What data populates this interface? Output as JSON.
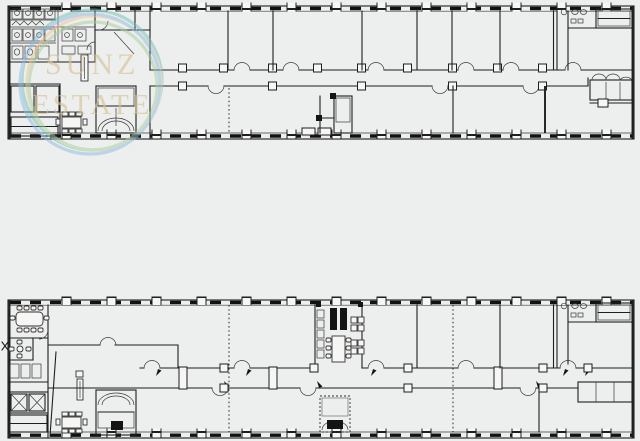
{
  "css_vars": {
    "page-bg": "#edeeee",
    "plan-fill": "#f6f6f4",
    "wall": "#1e1e1e",
    "wm-text": "#d6c093"
  },
  "watermark": {
    "line1": "SUNZ",
    "line2": "ESTATE",
    "text_color": "#d6c093",
    "ring_colors": [
      "#6fc3b4",
      "#ecc592",
      "#8db9e3",
      "#a7cf9b"
    ]
  }
}
